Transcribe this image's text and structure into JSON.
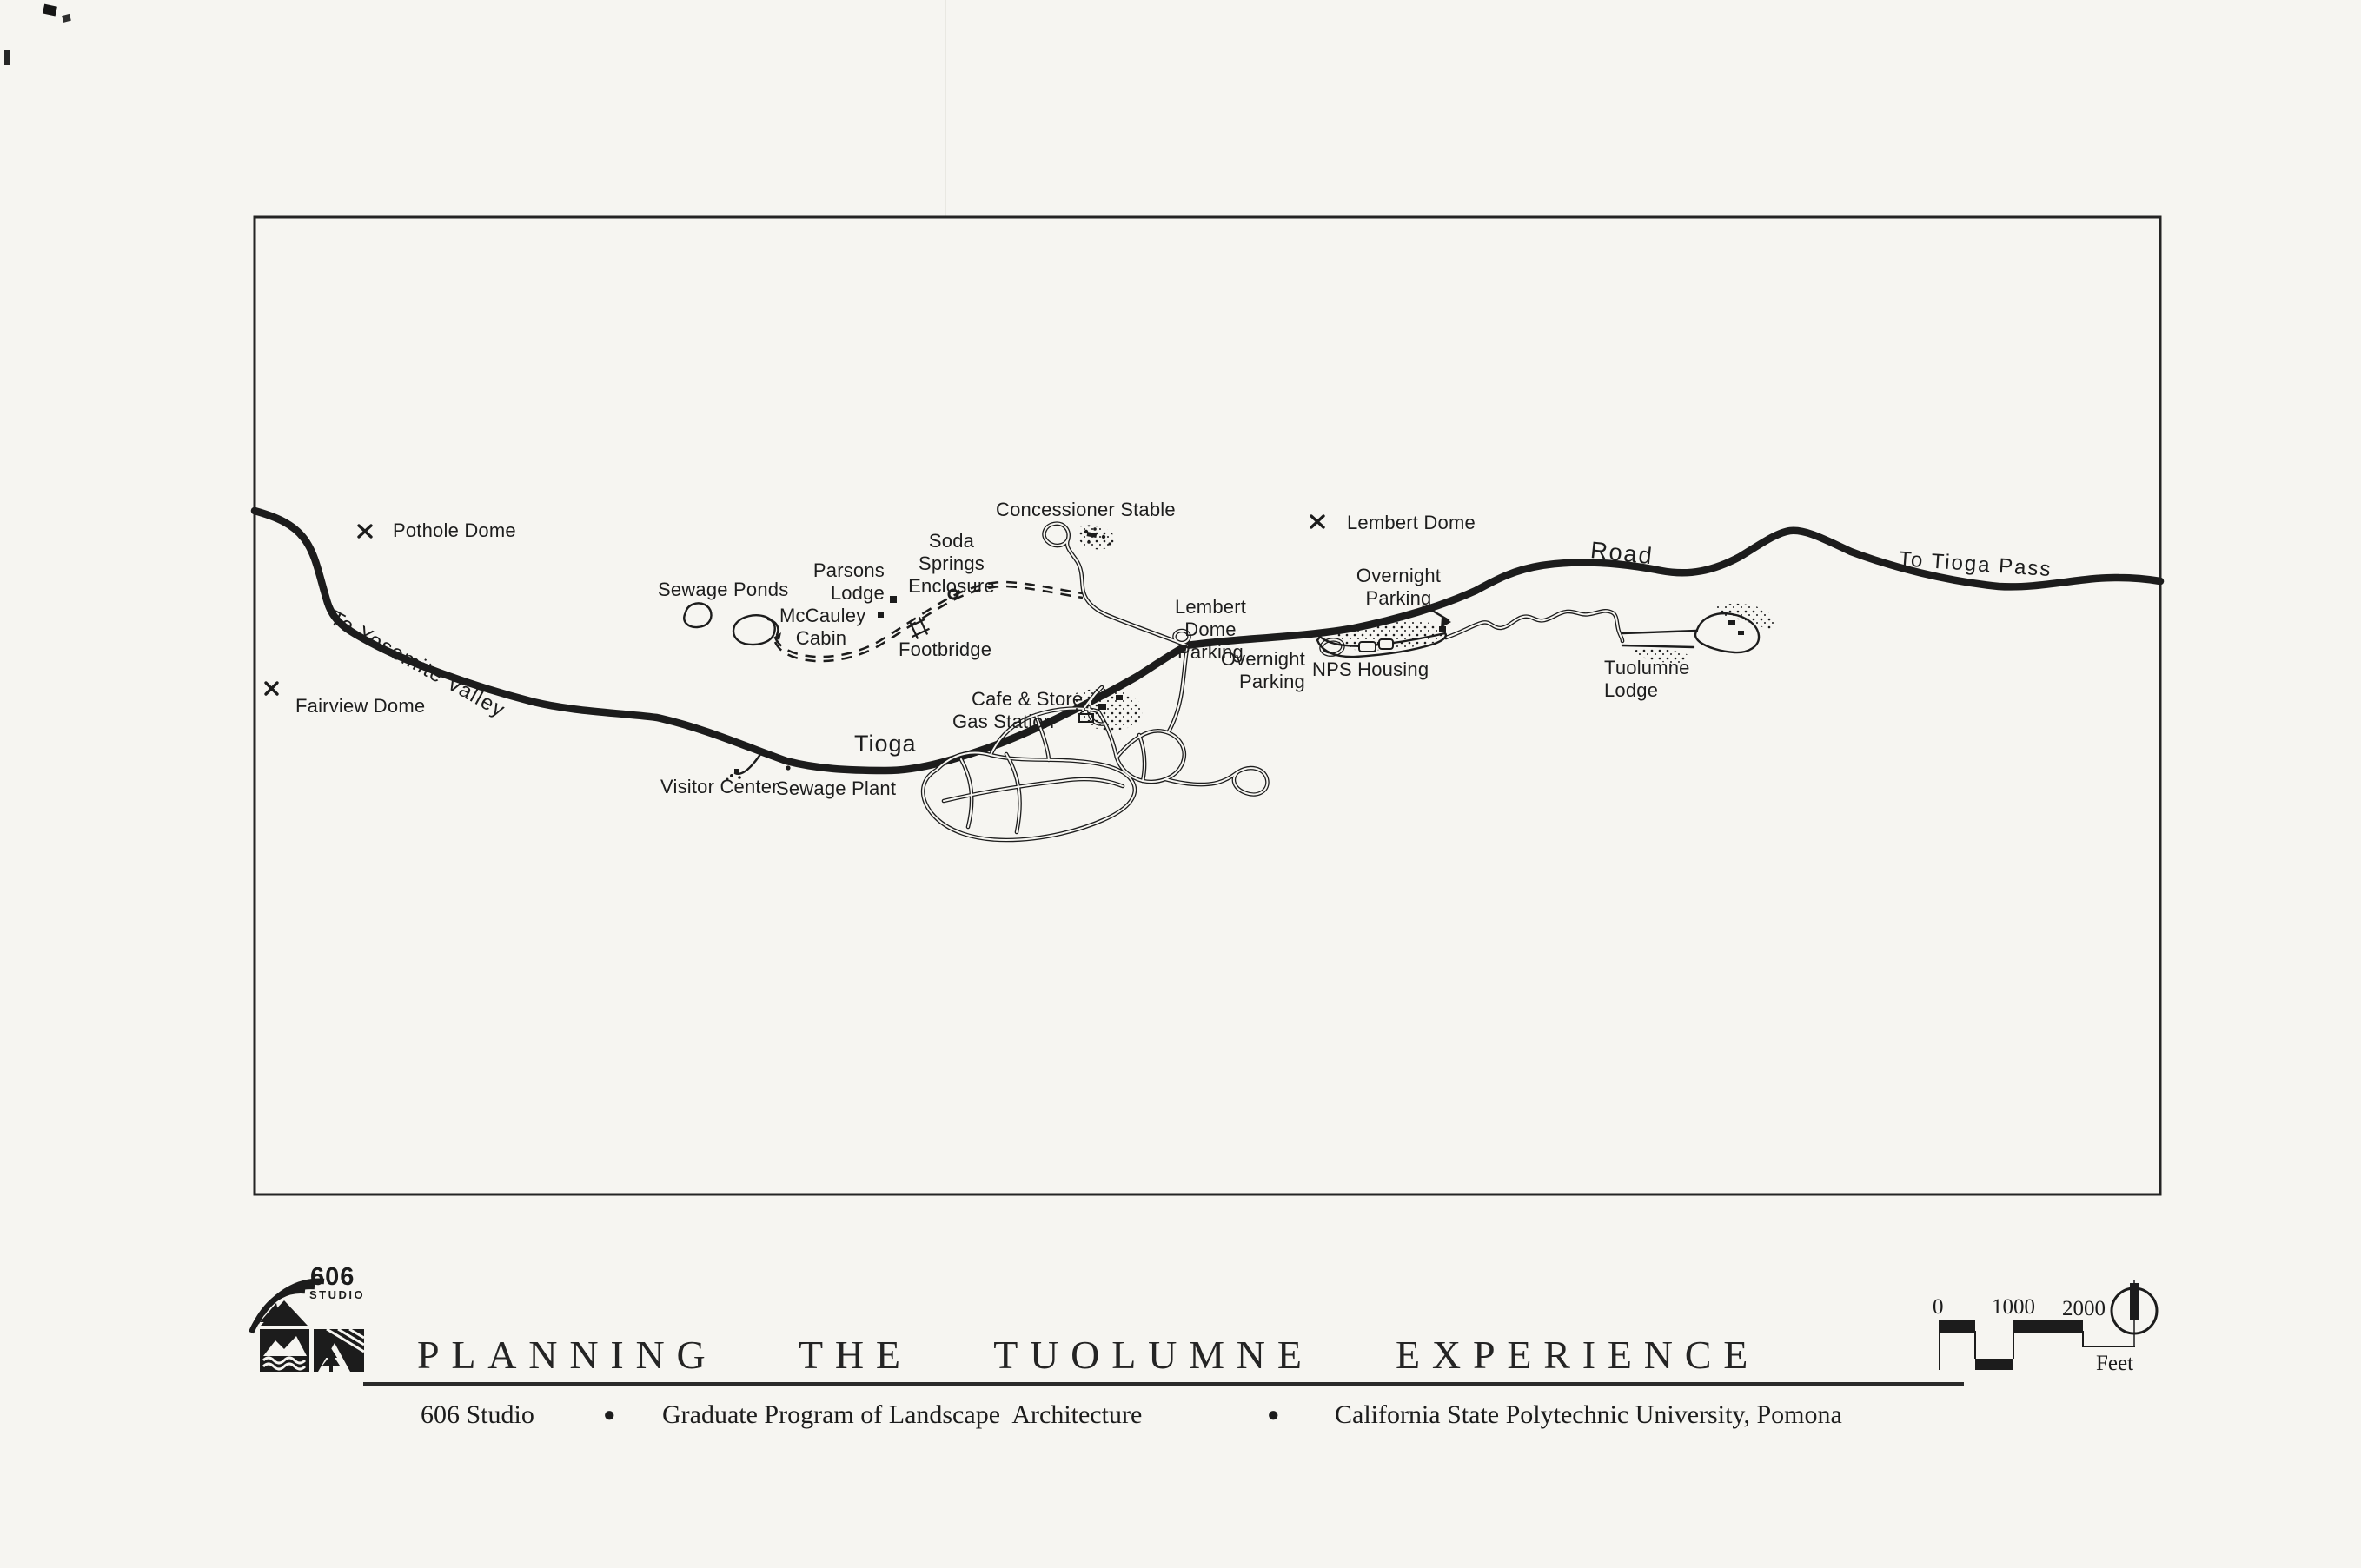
{
  "document": {
    "background": "#f6f5f1",
    "ink": "#1c1c1c"
  },
  "map": {
    "labels": {
      "pothole_dome": "Pothole Dome",
      "fairview_dome": "Fairview Dome",
      "to_yosemite_valley": "To Yosemite Valley",
      "sewage_ponds": "Sewage Ponds",
      "parsons_lodge": "Parsons\nLodge",
      "mccauley_cabin": "McCauley\nCabin",
      "soda_springs_enclosure": "Soda Springs\nEnclosure",
      "footbridge": "Footbridge",
      "concessioner_stable": "Concessioner Stable",
      "lembert_dome": "Lembert Dome",
      "lembert_dome_parking": "Lembert Dome\nParking",
      "overnight_parking_upper": "Overnight\nParking",
      "overnight_parking_lower": "Overnight\nParking",
      "nps_housing": "NPS Housing",
      "tuolumne_lodge": "Tuolumne\nLodge",
      "road": "Road",
      "tioga": "Tioga",
      "to_tioga_pass": "To Tioga Pass",
      "cafe_store": "Cafe & Store",
      "gas_station": "Gas Station",
      "visitor_center": "Visitor Center",
      "sewage_plant": "Sewage Plant"
    }
  },
  "footer": {
    "logo": {
      "number": "606",
      "word": "STUDIO"
    },
    "title": "PLANNING THE TUOLUMNE EXPERIENCE",
    "byline": {
      "studio": "606 Studio",
      "bullet": "●",
      "program": "Graduate Program of Landscape  Architecture",
      "university": "California State Polytechnic University, Pomona"
    },
    "scale_bar": {
      "tick_0": "0",
      "tick_1000": "1000",
      "tick_2000": "2000",
      "unit": "Feet"
    }
  }
}
